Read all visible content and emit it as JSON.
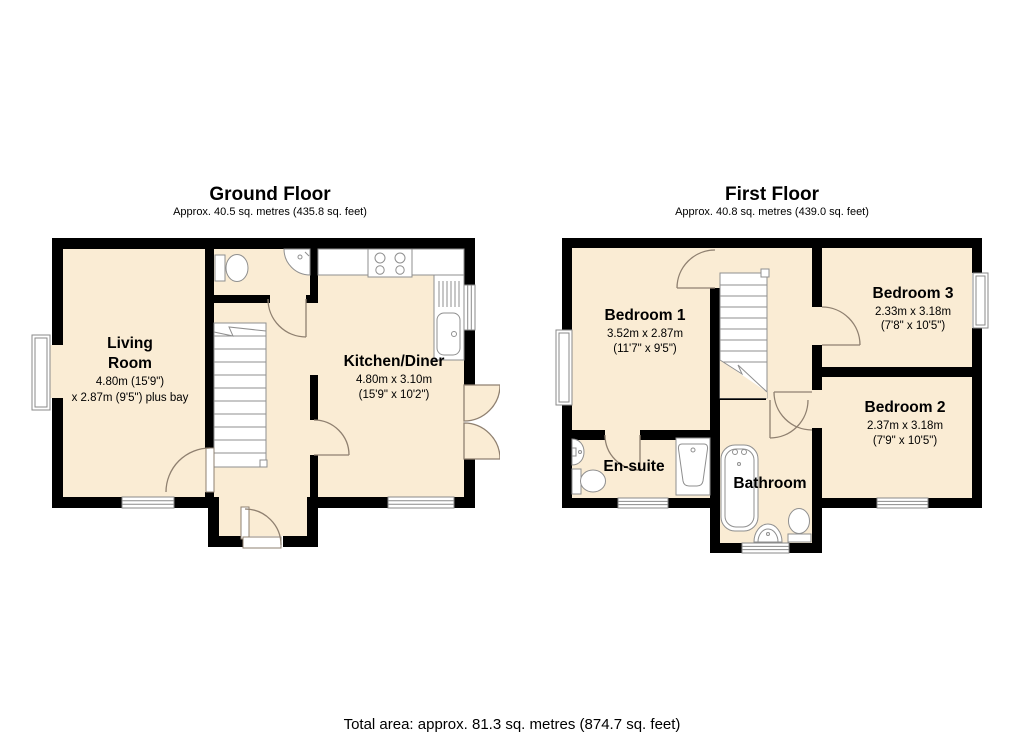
{
  "ground_floor": {
    "title": "Ground Floor",
    "subtitle": "Approx. 40.5 sq. metres (435.8 sq. feet)",
    "rooms": {
      "living_room": {
        "name1": "Living",
        "name2": "Room",
        "dim1": "4.80m (15'9\")",
        "dim2": "x 2.87m (9'5\") plus bay"
      },
      "kitchen_diner": {
        "name": "Kitchen/Diner",
        "dim1": "4.80m x 3.10m",
        "dim2": "(15'9\" x 10'2\")"
      }
    }
  },
  "first_floor": {
    "title": "First Floor",
    "subtitle": "Approx. 40.8 sq. metres (439.0 sq. feet)",
    "rooms": {
      "bedroom1": {
        "name": "Bedroom 1",
        "dim1": "3.52m x 2.87m",
        "dim2": "(11'7\" x 9'5\")"
      },
      "bedroom2": {
        "name": "Bedroom 2",
        "dim1": "2.37m x 3.18m",
        "dim2": "(7'9\" x 10'5\")"
      },
      "bedroom3": {
        "name": "Bedroom 3",
        "dim1": "2.33m x 3.18m",
        "dim2": "(7'8\" x 10'5\")"
      },
      "ensuite": {
        "name": "En-suite"
      },
      "bathroom": {
        "name": "Bathroom"
      }
    }
  },
  "footer": {
    "total_area": "Total area: approx. 81.3 sq. metres (874.7 sq. feet)"
  },
  "colors": {
    "floor_fill": "#FAECD4",
    "wall": "#000000",
    "door_arc": "#8f8070",
    "fixture_outline": "#8f8f8f"
  }
}
